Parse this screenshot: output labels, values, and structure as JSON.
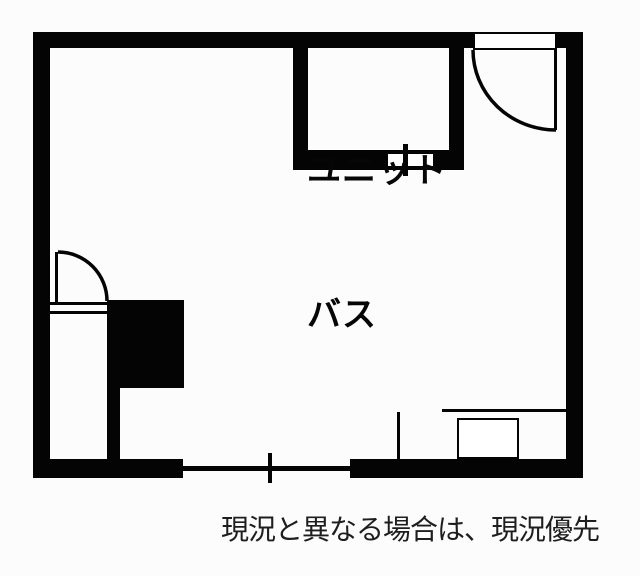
{
  "unit_bath": {
    "label": [
      "ユニット",
      "バス"
    ]
  },
  "caption": {
    "text": "現況と異なる場合は、現況優先"
  },
  "colors": {
    "wall": "#040404",
    "background": "#fcfcfc",
    "unit_bath_label_text": "#060606",
    "caption_text": "#1e1e1e"
  }
}
